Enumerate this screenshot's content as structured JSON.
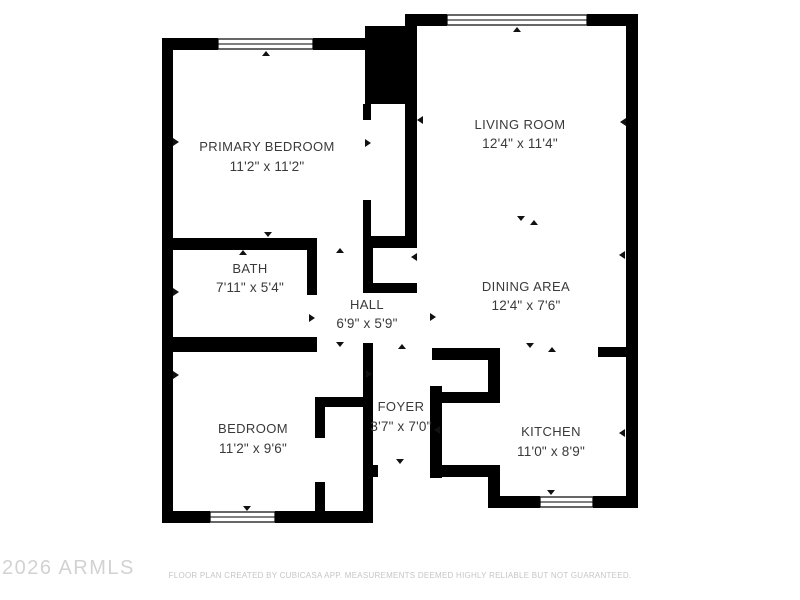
{
  "rooms": {
    "primary_bedroom": {
      "name": "PRIMARY BEDROOM",
      "dims": "11'2\" x 11'2\""
    },
    "living_room": {
      "name": "LIVING ROOM",
      "dims": "12'4\" x 11'4\""
    },
    "bath": {
      "name": "BATH",
      "dims": "7'11\" x 5'4\""
    },
    "hall": {
      "name": "HALL",
      "dims": "6'9\" x 5'9\""
    },
    "dining_area": {
      "name": "DINING AREA",
      "dims": "12'4\" x 7'6\""
    },
    "bedroom": {
      "name": "BEDROOM",
      "dims": "11'2\" x 9'6\""
    },
    "foyer": {
      "name": "FOYER",
      "dims": "3'7\" x 7'0\""
    },
    "kitchen": {
      "name": "KITCHEN",
      "dims": "11'0\" x 8'9\""
    }
  },
  "footer": {
    "watermark": "2026 ARMLS",
    "disclaimer": "FLOOR PLAN CREATED BY CUBICASA APP. MEASUREMENTS DEEMED HIGHLY RELIABLE BUT NOT GUARANTEED."
  },
  "colors": {
    "wall": "#000000",
    "label": "#3a3a3a",
    "watermark": "#d2d2d2",
    "disclaimer": "#c6c6c6"
  }
}
